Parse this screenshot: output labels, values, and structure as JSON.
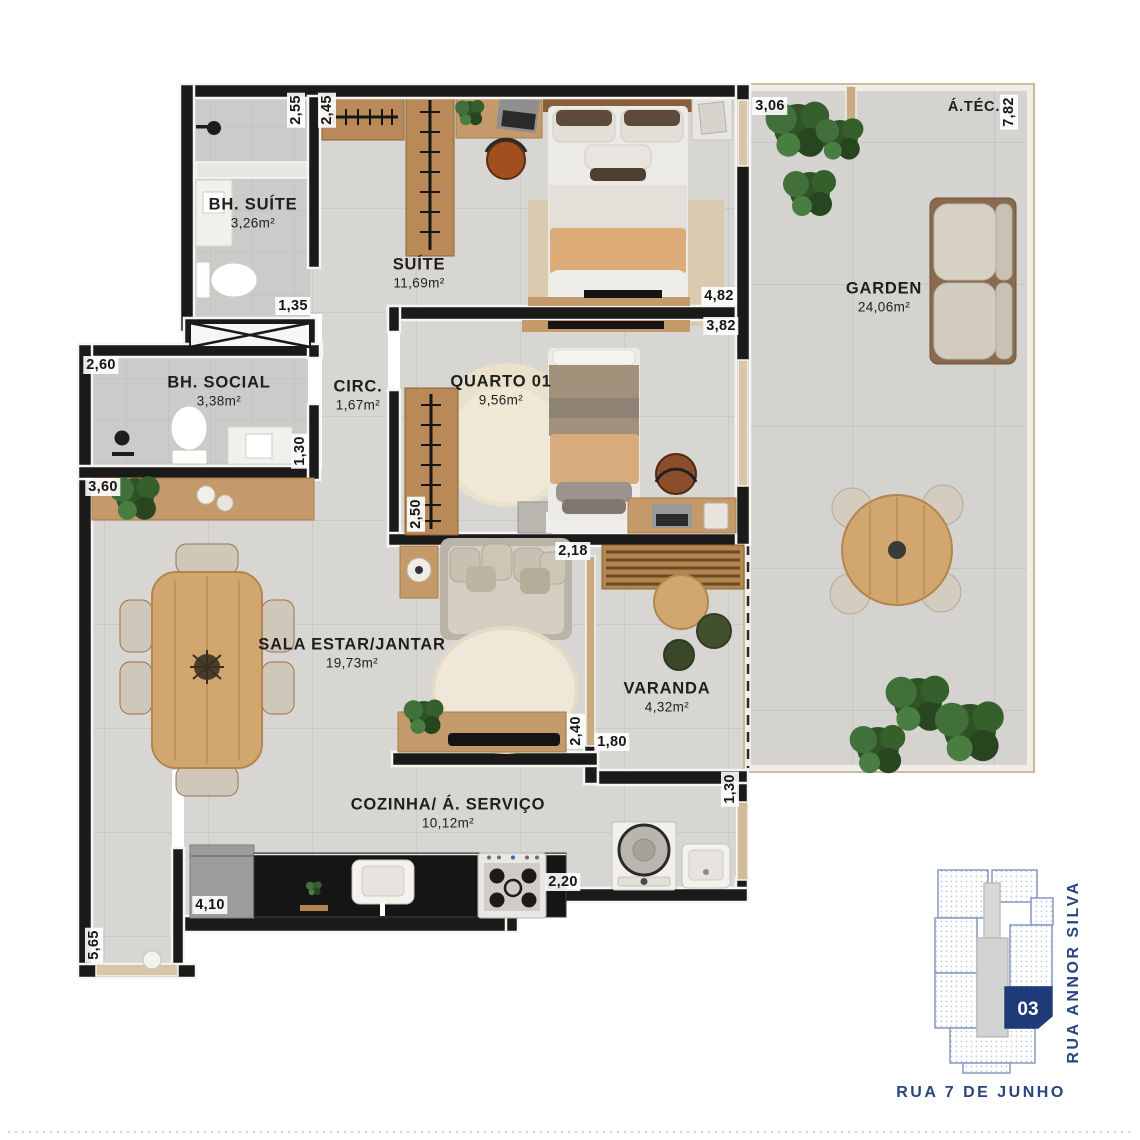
{
  "plan": {
    "rooms": {
      "bh_suite": {
        "name": "BH. SUÍTE",
        "area": "3,26m²"
      },
      "suite": {
        "name": "SUÍTE",
        "area": "11,69m²"
      },
      "bh_social": {
        "name": "BH. SOCIAL",
        "area": "3,38m²"
      },
      "circ": {
        "name": "CIRC.",
        "area": "1,67m²"
      },
      "quarto01": {
        "name": "QUARTO 01",
        "area": "9,56m²"
      },
      "garden": {
        "name": "GARDEN",
        "area": "24,06m²"
      },
      "atec": {
        "name": "Á.TÉC."
      },
      "sala": {
        "name": "SALA ESTAR/JANTAR",
        "area": "19,73m²"
      },
      "varanda": {
        "name": "VARANDA",
        "area": "4,32m²"
      },
      "cozinha": {
        "name": "COZINHA/ Á. SERVIÇO",
        "area": "10,12m²"
      }
    },
    "dims": {
      "d255": "2,55",
      "d245": "2,45",
      "d306": "3,06",
      "d782": "7,82",
      "d135": "1,35",
      "d482": "4,82",
      "d382": "3,82",
      "d260": "2,60",
      "d130a": "1,30",
      "d360": "3,60",
      "d250": "2,50",
      "d218": "2,18",
      "d240": "2,40",
      "d180": "1,80",
      "d130b": "1,30",
      "d220": "2,20",
      "d410": "4,10",
      "d565": "5,65"
    }
  },
  "keyplan": {
    "unit": "03",
    "street_right": "RUA ANNOR SILVA",
    "street_bottom": "RUA 7 DE JUNHO"
  },
  "colors": {
    "wall": "#1a1a1a",
    "floor_tile": "#d8d6d3",
    "bath_tile": "#cecdcb",
    "wood": "#c59a6b",
    "wood_dark": "#b3854f",
    "counter_black": "#151515",
    "plant_green": "#2f5227",
    "keyplan_navy": "#1e3a78",
    "keyplan_blue": "#7e95bc",
    "street_text": "#27457e"
  }
}
